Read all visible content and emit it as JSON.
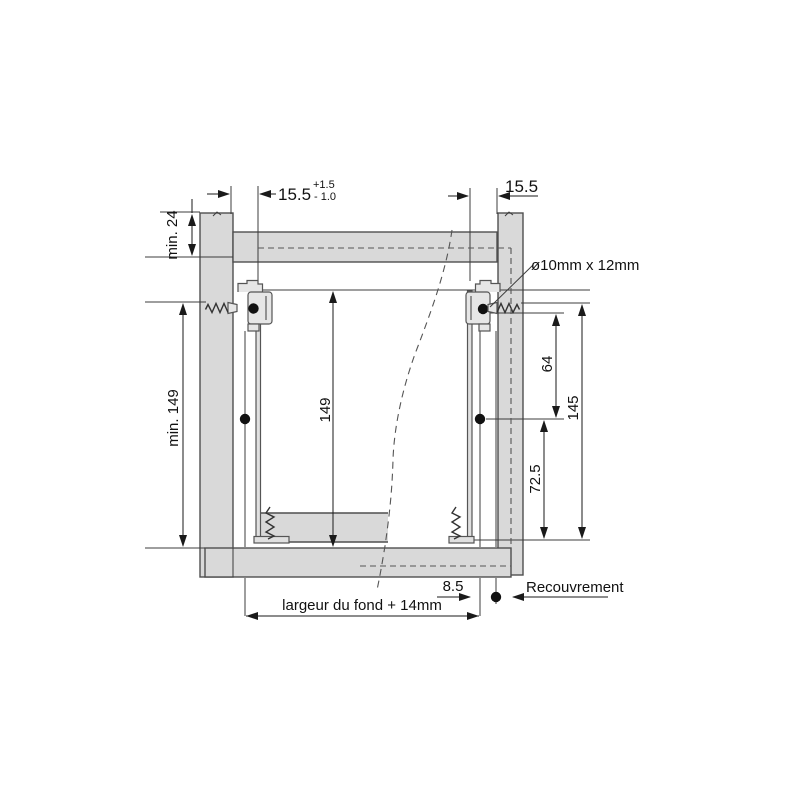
{
  "dims": {
    "min_top_clearance": "min. 24",
    "side_gap_left": "15.5",
    "side_gap_left_tol_plus": "+1.5",
    "side_gap_left_tol_minus": "- 1.0",
    "side_gap_right": "15.5",
    "min_side_height": "min. 149",
    "profile_height": "149",
    "hole_spacing": "64",
    "total_height": "145",
    "hole_to_front": "72.5",
    "front_screw_offset": "8.5"
  },
  "labels": {
    "dowel": "ø10mm x 12mm",
    "overlay": "Recouvrement",
    "bottom_width": "largeur du fond + 14mm"
  },
  "colors": {
    "panel_fill": "#d9d9d9",
    "bracket_fill": "#e6e6e6",
    "profile_fill": "#e0e0e0",
    "dim": "#1a1a1a",
    "bg": "#ffffff"
  }
}
